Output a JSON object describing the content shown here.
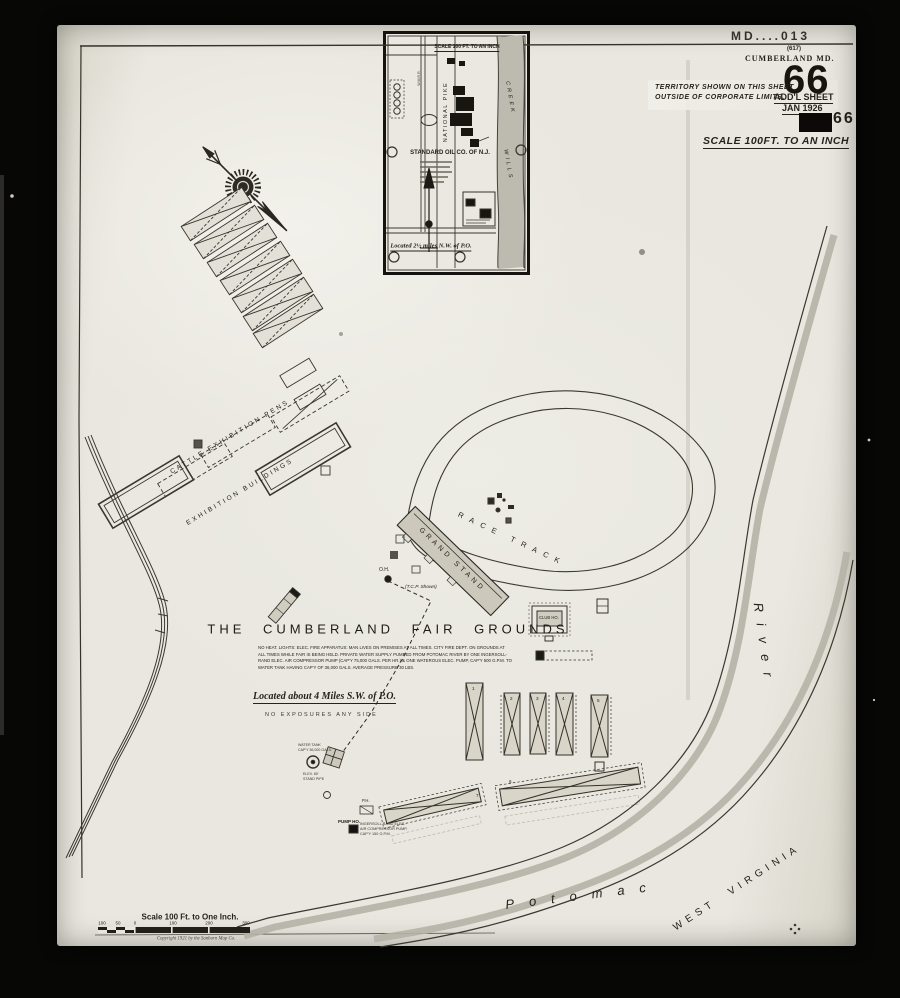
{
  "corner": {
    "stamp": "MD....013",
    "small_index": "(617)",
    "city": "CUMBERLAND MD.",
    "sheet_number": "66",
    "addl_sheet": "ADD'L SHEET",
    "date": "JAN 1926",
    "ghost_number": "66"
  },
  "territory": [
    "TERRITORY SHOWN ON THIS SHEET",
    "OUTSIDE OF CORPORATE LIMITS."
  ],
  "scale_heading": "SCALE 100FT. TO AN INCH",
  "inset": {
    "scale": "SCALE 100 FT. TO AN INCH",
    "railroad": "W.M.R.R.",
    "street": "NATIONAL PIKE",
    "creek_word1": "WILLS",
    "creek_word2": "CREEK",
    "company": "STANDARD OIL CO. OF N.J.",
    "located": "Located 2½ miles N.W. of P.O."
  },
  "map": {
    "title": "THE CUMBERLAND FAIR GROUNDS",
    "cattle_pens": "CATTLE EXHIBITION PENS",
    "exhibition_buildings": "EXHIBITION BUILDINGS",
    "race_track": "RACE TRACK",
    "grand_stand": "GRAND STAND",
    "tcp_note": "(T.C.P. Shown)",
    "club_house": "CLUB HO.",
    "oh": "O.H.",
    "ph": "P.H.",
    "located": "Located about 4 Miles S.W. of P.O.",
    "no_exposures": "NO EXPOSURES ANY SIDE",
    "notes": [
      "NO HEAT. LIGHTS: ELEC. FIRE APPARATUS: MAN LIVES ON PREMISES AT ALL TIMES. CITY FIRE DEPT. ON GROUNDS AT",
      "ALL TIMES WHILE FAIR IS BEING HELD. PRIVATE WATER SUPPLY PUMPED FROM POTOMAC RIVER BY ONE INGERSOLL-",
      "RAND ELEC. AIR COMPRESSOR PUMP (CAP'Y 75,000 GALS. PER HR.) & ONE WATEROUS ELEC. PUMP, CAP'Y 500 G.P.M. TO",
      "WATER TANK HAVING CAP'Y OF 36,000 GALS. AVERAGE PRESSURE 30 LBS."
    ],
    "pump": [
      "PUMP HO.",
      "INGERSOLL RAND ELEC.",
      "AIR COMPRESSOR PUMP,",
      "CAP'Y 150 G.P.M."
    ],
    "tank": [
      "WATER TANK",
      "CAP'Y 36,000 GALS.",
      "ELEV. 80'",
      "STAND PIPE"
    ],
    "shed_numbers": [
      "1",
      "2",
      "3",
      "4",
      "5",
      "6",
      "7"
    ]
  },
  "river": {
    "potomac": "Potomac",
    "river": "River",
    "state": "WEST VIRGINIA"
  },
  "scale_bar": {
    "title": "Scale 100 Ft. to One Inch.",
    "ticks": [
      "100",
      "50",
      "0",
      "100",
      "200",
      "300"
    ],
    "copyright": "Copyright 1921 by the Sanborn Map Co."
  },
  "colors": {
    "paper": "#e7e5dd",
    "ink": "#2b2822",
    "river_shade": "#b5b2a6",
    "photo_bg": "#070706"
  }
}
